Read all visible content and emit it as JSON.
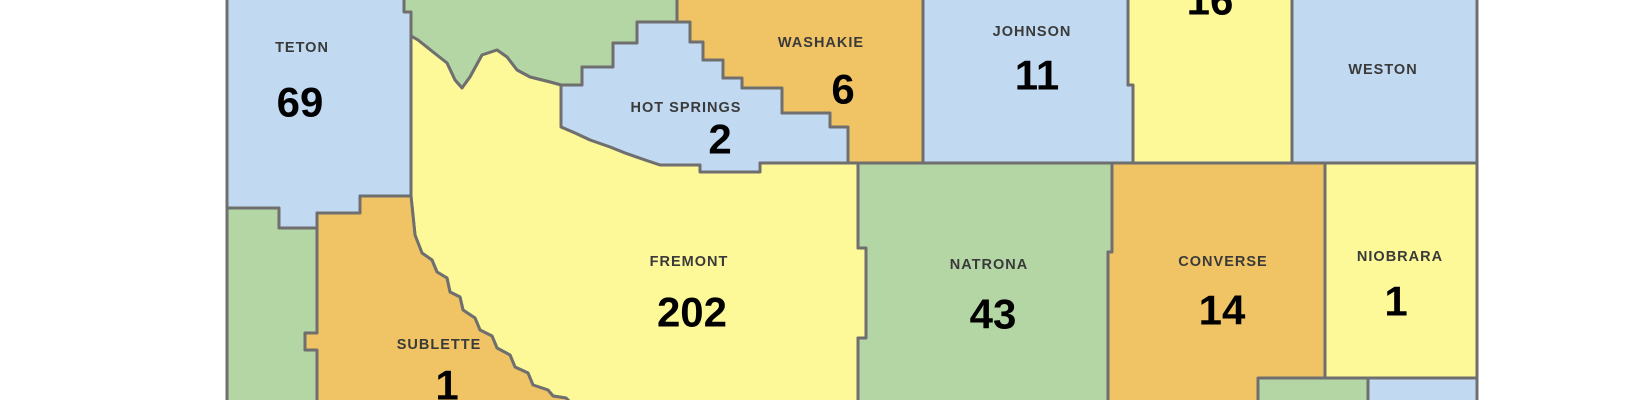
{
  "map": {
    "description": "Wyoming county map with count per county",
    "palette": {
      "blue": "#c1d9f1",
      "green": "#b4d6a5",
      "yellow": "#fdf898",
      "orange": "#f0c464",
      "border": "#6f6f6f",
      "name_text": "#3a3a3a",
      "number_text": "#000000",
      "background": "#ffffff"
    },
    "counties": [
      {
        "id": "teton",
        "label": "TETON",
        "value": "69",
        "color": "blue"
      },
      {
        "id": "hot-springs",
        "label": "HOT SPRINGS",
        "value": "2",
        "color": "blue"
      },
      {
        "id": "washakie",
        "label": "WASHAKIE",
        "value": "6",
        "color": "orange"
      },
      {
        "id": "johnson",
        "label": "JOHNSON",
        "value": "11",
        "color": "blue"
      },
      {
        "id": "campbell-area",
        "label": "",
        "value": "16",
        "color": "yellow",
        "partially_visible": true
      },
      {
        "id": "weston",
        "label": "WESTON",
        "value": "",
        "color": "blue"
      },
      {
        "id": "fremont",
        "label": "FREMONT",
        "value": "202",
        "color": "yellow"
      },
      {
        "id": "natrona",
        "label": "NATRONA",
        "value": "43",
        "color": "green"
      },
      {
        "id": "converse",
        "label": "CONVERSE",
        "value": "14",
        "color": "orange"
      },
      {
        "id": "niobrara",
        "label": "NIOBRARA",
        "value": "1",
        "color": "yellow"
      },
      {
        "id": "sublette",
        "label": "SUBLETTE",
        "value": "1",
        "color": "orange"
      }
    ]
  }
}
